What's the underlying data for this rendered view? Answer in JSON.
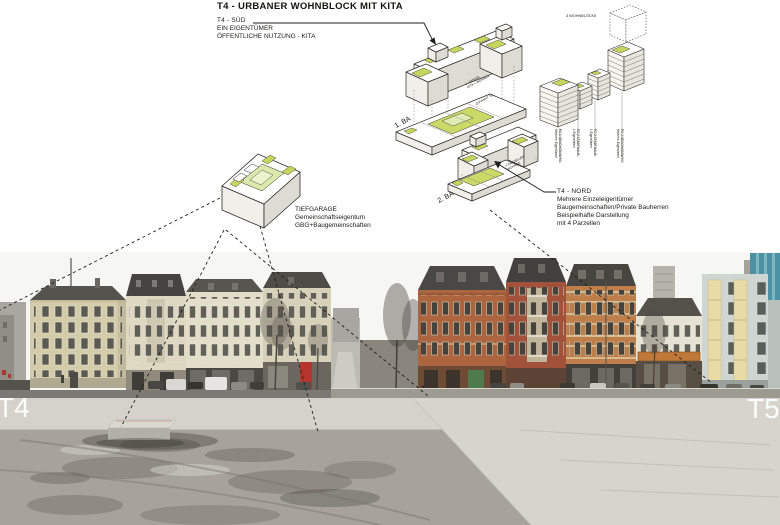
{
  "title": "T4 - URBANER WOHNBLOCK MIT KITA",
  "callouts": {
    "sued": {
      "heading": "T4 - SÜD",
      "lines": [
        "EIN EIGENTÜMER",
        "ÖFFENTLICHE NUTZUNG - KITA"
      ]
    },
    "nord": {
      "heading": "T4 - NORD",
      "lines": [
        "Mehrere Einzeleigentümer",
        "Baugemeinschaften/Private Bauherren",
        "Beispielhafte Darstellung",
        "mit 4 Parzellen"
      ]
    },
    "tiefgarage": {
      "lines": [
        "TIEFGARAGE",
        "Gemeinschaftseigentum",
        "GBG+Baugemeinschaften"
      ]
    }
  },
  "phases": {
    "ba1": "1. BA",
    "ba2": "2. BA"
  },
  "parcel_diagram": {
    "heading": "3 WOHNBLÖCKE",
    "labels": [
      {
        "l1": "PZ.1 GESCHOSSWHG.",
        "l2": "Mehrere Eigentümer"
      },
      {
        "l1": "PZ.2 STADTHAUS",
        "l2": "1 Eigentümer"
      },
      {
        "l1": "PZ.3 STADTHAUS",
        "l2": "1 Eigentümer"
      },
      {
        "l1": "PZ.4 GESCHOSSWHG.",
        "l2": "Mehrere Eigentümer"
      }
    ]
  },
  "micro_labels": {
    "handel1": "1. HANDEL",
    "handel2": "KITA + WOHNEN",
    "zufahrt": "ZUFAHRT TG",
    "parzellen1": "4 PARZELLEN",
    "parzellen2": "WOHNEN"
  },
  "photo": {
    "label_left": "T4",
    "label_right": "T5"
  },
  "colors": {
    "roof_green": "#c5d65e",
    "courtyard_green": "#dce8ab",
    "diagram_line": "#2e2e2a",
    "ground_light": "#d6d4cc",
    "ground_dark": "#a7a39b"
  }
}
